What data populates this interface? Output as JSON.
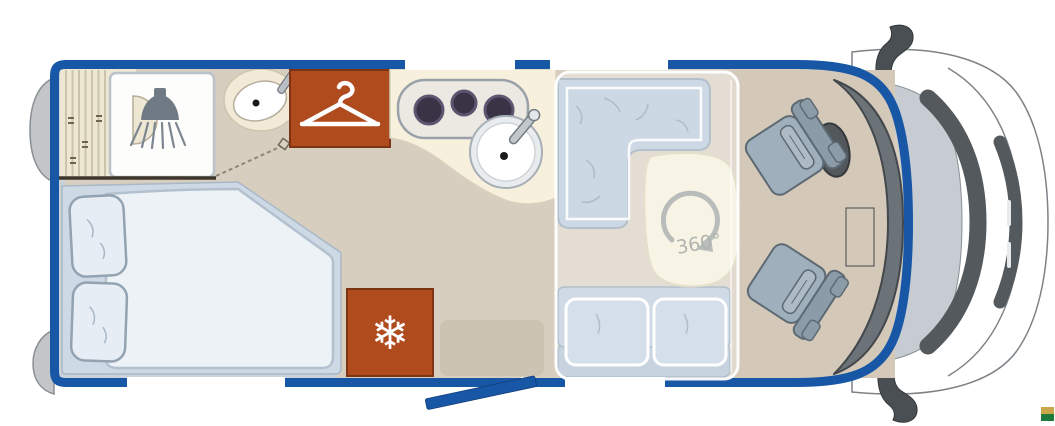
{
  "title": "motorhome-floorplan-top-view",
  "labels": {
    "rotation": "360°"
  },
  "glyphs": {
    "snowflake": "❄"
  },
  "colors": {
    "border_blue": "#1856a6",
    "door_blue": "#1856a6",
    "window_white": "#ffffff",
    "floor": "#d7cec0",
    "cab_floor": "#d4c9b8",
    "edge_strip": "#cbd3da",
    "counter": "#f7f0dc",
    "rust": "#b04b1e",
    "stripe_panel": "#eee7d4",
    "shower_white": "#fdfdfc",
    "mattress": "#edf2f7",
    "bed_frame": "#cdd9e4",
    "pillow": "#e7edf4",
    "sofa": "#b7c8d9",
    "bench_seat": "#bccbdb",
    "bench_back": "#b0c1d3",
    "cushion": "#c3d2e0",
    "table": "#f5f0da",
    "arrow_gray": "#9aa09e",
    "label_gray": "#8f948e",
    "seat": "#9fb0bc",
    "seat_back": "#8b9ca8",
    "armrest": "#aebbc5",
    "dashboard": "#6c7378",
    "windshield": "#c6ccd2",
    "pillar": "#54595d",
    "mirror": "#4a4f53",
    "wheel": "#53585c",
    "bumper": "#c3c6c8",
    "cab_body": "#ffffff",
    "icon_gray": "#76808a",
    "icon_white": "#ffffff",
    "logo_gold": "#c8a84b",
    "logo_green": "#1e7a3c"
  },
  "areas": {
    "bathroom": "shower-and-washbasin",
    "wardrobe": "hanger-closet",
    "kitchen": "stove-and-sink",
    "bedroom": "double-bed",
    "fridge": "refrigerator",
    "dinette": "l-shaped-lounge-with-swivel-table",
    "cab": "driver-and-passenger-swivel-seats",
    "entry": "open-entry-door"
  }
}
